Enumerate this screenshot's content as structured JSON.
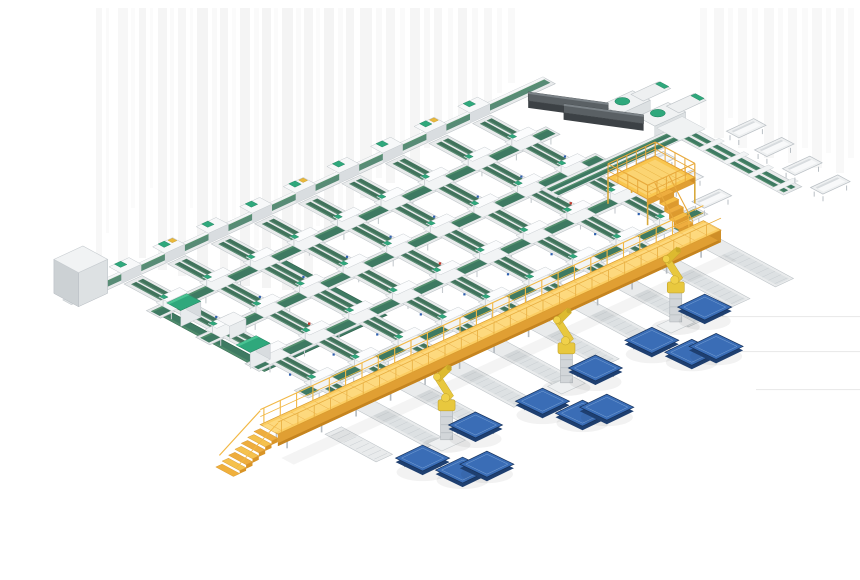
{
  "scene": {
    "palette": {
      "streak": "#d9d9d9",
      "beltGreen": "#41735c",
      "beltGreenLight": "#5d8f76",
      "beltGreenDark": "#2f5a47",
      "loopGreen": "#3e7a62",
      "loopGreenLight": "#55916f",
      "loopGreenDark": "#2c5f4a",
      "teal": "#2fa87c",
      "tealDark": "#1f7d5a",
      "tealLight": "#49c393",
      "frameFill": "#e9ebec",
      "frameStroke": "#bdc3c7",
      "frameLight": "#f6f7f8",
      "frameMid": "#dde1e3",
      "frameDark": "#c9ced2",
      "walkTop": "#fbcd62",
      "walkTopLight": "#fdd97e",
      "walkSide": "#e09f33",
      "walkDark": "#cf8f28",
      "railYellow": "#f2b845",
      "robotYellow": "#e8c83e",
      "robotYellowDark": "#c3a32a",
      "robotJoint": "#f0d14a",
      "robotGray": "#d2d6d9",
      "palletTop": "#3a6db6",
      "palletDark": "#1e3f70",
      "palletHi": "#7aa3d6",
      "machineDark": "#3c4145",
      "machineMid": "#5a6064",
      "machineHi": "#7b8287",
      "grayTop": "#f1f3f4",
      "grayLeft": "#ccd1d4",
      "grayFront": "#dde1e3",
      "blueDot": "#2d5fae",
      "redDot": "#c23b2e",
      "shadow": "#2a2a2a"
    },
    "field": {
      "origin": [
        88,
        290
      ],
      "axisA": [
        0.908,
        -0.418
      ],
      "axisB": [
        0.88,
        0.475
      ]
    },
    "streaks": [
      [
        96,
        6,
        255,
        0.22
      ],
      [
        106,
        3,
        225,
        0.13
      ],
      [
        118,
        10,
        258,
        0.2
      ],
      [
        131,
        4,
        200,
        0.11
      ],
      [
        139,
        7,
        250,
        0.25
      ],
      [
        150,
        3,
        180,
        0.1
      ],
      [
        158,
        9,
        262,
        0.27
      ],
      [
        170,
        4,
        230,
        0.13
      ],
      [
        178,
        8,
        268,
        0.24
      ],
      [
        190,
        3,
        200,
        0.11
      ],
      [
        197,
        11,
        272,
        0.29
      ],
      [
        212,
        5,
        235,
        0.15
      ],
      [
        220,
        8,
        275,
        0.27
      ],
      [
        232,
        4,
        210,
        0.11
      ],
      [
        240,
        10,
        278,
        0.3
      ],
      [
        254,
        5,
        240,
        0.13
      ],
      [
        262,
        9,
        280,
        0.29
      ],
      [
        274,
        4,
        215,
        0.11
      ],
      [
        282,
        11,
        282,
        0.3
      ],
      [
        296,
        5,
        245,
        0.14
      ],
      [
        304,
        9,
        285,
        0.27
      ],
      [
        316,
        4,
        218,
        0.11
      ],
      [
        324,
        10,
        230,
        0.29
      ],
      [
        338,
        5,
        200,
        0.13
      ],
      [
        346,
        8,
        210,
        0.25
      ],
      [
        360,
        12,
        190,
        0.27
      ],
      [
        376,
        6,
        170,
        0.16
      ],
      [
        386,
        9,
        175,
        0.23
      ],
      [
        400,
        5,
        150,
        0.13
      ],
      [
        410,
        10,
        160,
        0.27
      ],
      [
        424,
        6,
        140,
        0.18
      ],
      [
        434,
        8,
        130,
        0.23
      ],
      [
        448,
        5,
        120,
        0.14
      ],
      [
        458,
        9,
        115,
        0.25
      ],
      [
        472,
        6,
        100,
        0.16
      ],
      [
        484,
        8,
        95,
        0.21
      ],
      [
        497,
        5,
        85,
        0.13
      ],
      [
        508,
        7,
        75,
        0.17
      ],
      [
        700,
        7,
        120,
        0.16
      ],
      [
        714,
        10,
        130,
        0.2
      ],
      [
        728,
        5,
        110,
        0.12
      ],
      [
        738,
        9,
        140,
        0.18
      ],
      [
        752,
        6,
        120,
        0.14
      ],
      [
        764,
        10,
        150,
        0.2
      ],
      [
        778,
        5,
        130,
        0.12
      ],
      [
        788,
        9,
        155,
        0.18
      ],
      [
        802,
        6,
        140,
        0.14
      ],
      [
        812,
        10,
        160,
        0.2
      ],
      [
        826,
        5,
        145,
        0.12
      ],
      [
        836,
        8,
        165,
        0.18
      ],
      [
        848,
        6,
        150,
        0.14
      ]
    ],
    "hlines": [
      [
        688,
        316
      ],
      [
        724,
        351
      ],
      [
        756,
        389
      ]
    ],
    "loop": {
      "u1": 15,
      "v1": 55,
      "u2": 150,
      "v2": 185,
      "band": 10
    },
    "crossRows": {
      "v": [
        54,
        110,
        166,
        222
      ],
      "u1": 12,
      "u2": 452
    },
    "infeedLine": {
      "u1": 0,
      "u2": 505,
      "v1": -4,
      "v2": 10
    },
    "lanes": {
      "u": [
        30,
        78,
        126,
        174,
        222,
        270,
        318,
        366,
        414
      ],
      "ties": [
        50,
        106,
        162,
        218
      ],
      "greenEnd": 250,
      "whiteEnd": 356
    },
    "stubLane": {
      "u1": -18,
      "v1": 288,
      "u2": 0,
      "v2": 346
    },
    "grayBox": {
      "u1": -24,
      "v1": -14,
      "u2": 8,
      "v2": 14,
      "h": 34
    },
    "cabinets": [
      [
        15,
        74
      ],
      [
        10,
        158
      ]
    ],
    "whiteBox": [
      30,
      116
    ],
    "machines": [
      [
        490,
        78
      ],
      [
        498,
        110
      ]
    ],
    "topStubs": [
      [
        536,
        64
      ],
      [
        544,
        96
      ]
    ],
    "transfer": {
      "u1": 380,
      "v1": 122,
      "u2": 532,
      "v2": 140
    },
    "spur": {
      "u1": 518,
      "v1": 118,
      "u2": 538,
      "v2": 256
    },
    "bins": {
      "left": [
        [
          460,
          148
        ],
        [
          456,
          184
        ],
        [
          452,
          220
        ]
      ],
      "right": [
        [
          550,
          158
        ],
        [
          546,
          194
        ],
        [
          542,
          230
        ],
        [
          538,
          266
        ]
      ]
    },
    "platform": {
      "u1": 404,
      "v1": 174,
      "u2": 456,
      "v2": 219,
      "h": 26,
      "stairU1": 412,
      "stairU2": 428
    },
    "walkway": {
      "u1": -70,
      "u2": 418,
      "v1": 268,
      "v2": 288,
      "deckZ": 22,
      "beamZ": 10
    },
    "robots": [
      [
        46,
        360
      ],
      [
        180,
        358
      ],
      [
        312,
        346
      ]
    ],
    "palletOffsets": [
      [
        -40,
        14,
        1
      ],
      [
        28,
        4,
        1
      ],
      [
        -25,
        44,
        0
      ],
      [
        -4,
        50,
        0
      ]
    ]
  }
}
